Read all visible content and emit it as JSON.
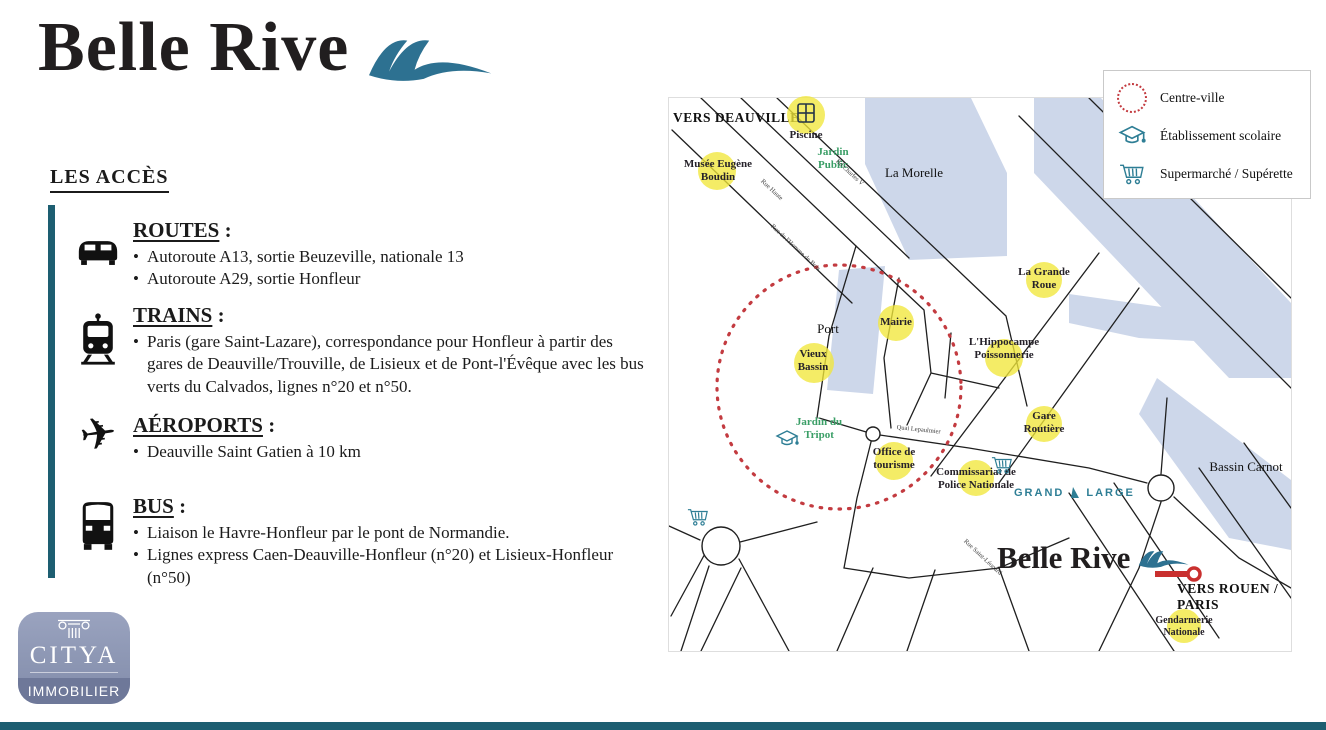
{
  "header": {
    "title": "Belle Rive"
  },
  "access": {
    "heading": "LES ACCÈS",
    "colon": ":",
    "sections": [
      {
        "icon": "car-icon",
        "title": "ROUTES",
        "items": [
          "Autoroute A13, sortie Beuzeville, nationale 13",
          "Autoroute A29, sortie Honfleur"
        ]
      },
      {
        "icon": "train-icon",
        "title": "TRAINS",
        "items": [
          "Paris (gare Saint-Lazare), correspondance pour Honfleur à partir des gares de Deauville/Trouville, de Lisieux et de Pont-l'Évêque avec les bus verts du Calvados, lignes n°20 et n°50."
        ]
      },
      {
        "icon": "plane-icon",
        "title": "AÉROPORTS",
        "items": [
          "Deauville Saint Gatien à 10 km"
        ]
      },
      {
        "icon": "bus-icon",
        "title": "BUS",
        "items": [
          "Liaison le Havre-Honfleur par le pont de Normandie.",
          "Lignes express Caen-Deauville-Honfleur (n°20) et Lisieux-Honfleur (n°50)"
        ]
      }
    ]
  },
  "citya": {
    "name": "CITYA",
    "tagline": "IMMOBILIER"
  },
  "legend": {
    "items": [
      {
        "icon": "centre-ville-circle",
        "label": "Centre-ville"
      },
      {
        "icon": "school-icon",
        "label": "Établissement scolaire"
      },
      {
        "icon": "supermarket-icon",
        "label": "Supermarché / Supérette"
      }
    ]
  },
  "map": {
    "brand": "Belle Rive",
    "vers_deauville": "VERS DEAUVILLE",
    "vers_rouen": "VERS ROUEN / PARIS",
    "la_morelle": "La Morelle",
    "port": "Port",
    "bassin_carnot": "Bassin Carnot",
    "grand_large": {
      "word1": "GRAND",
      "word2": "LARGE"
    },
    "pois": [
      {
        "name": "Piscine"
      },
      {
        "name": "Musée Eugène Boudin"
      },
      {
        "name": "Mairie"
      },
      {
        "name": "Vieux Bassin"
      },
      {
        "name": "La Grande Roue"
      },
      {
        "name": "L'Hippocampe Poissonnerie"
      },
      {
        "name": "Gare Routière"
      },
      {
        "name": "Office de tourisme"
      },
      {
        "name": "Commissariat de Police Nationale"
      },
      {
        "name": "Gendarmerie Nationale"
      }
    ],
    "parks": [
      {
        "name": "Jardin Public"
      },
      {
        "name": "Jardin du Tripot"
      }
    ],
    "streets": [
      "Bd Charles V",
      "Rue Haute",
      "Rue de l'Homme de Bois",
      "Quai Lepaulmier",
      "Rue Saint-Léonard"
    ]
  },
  "colors": {
    "accent_teal": "#1d5e71",
    "wave_teal": "#2d7191",
    "water_blue": "#cdd7ea",
    "highlight_yellow": "#f1e73b",
    "centre_ville_red": "#c33b40",
    "park_green": "#3a9e66",
    "icon_teal": "#2e7e95",
    "citya_badge_blue": "#8c96b3",
    "citya_band_blue": "#6e7899"
  }
}
